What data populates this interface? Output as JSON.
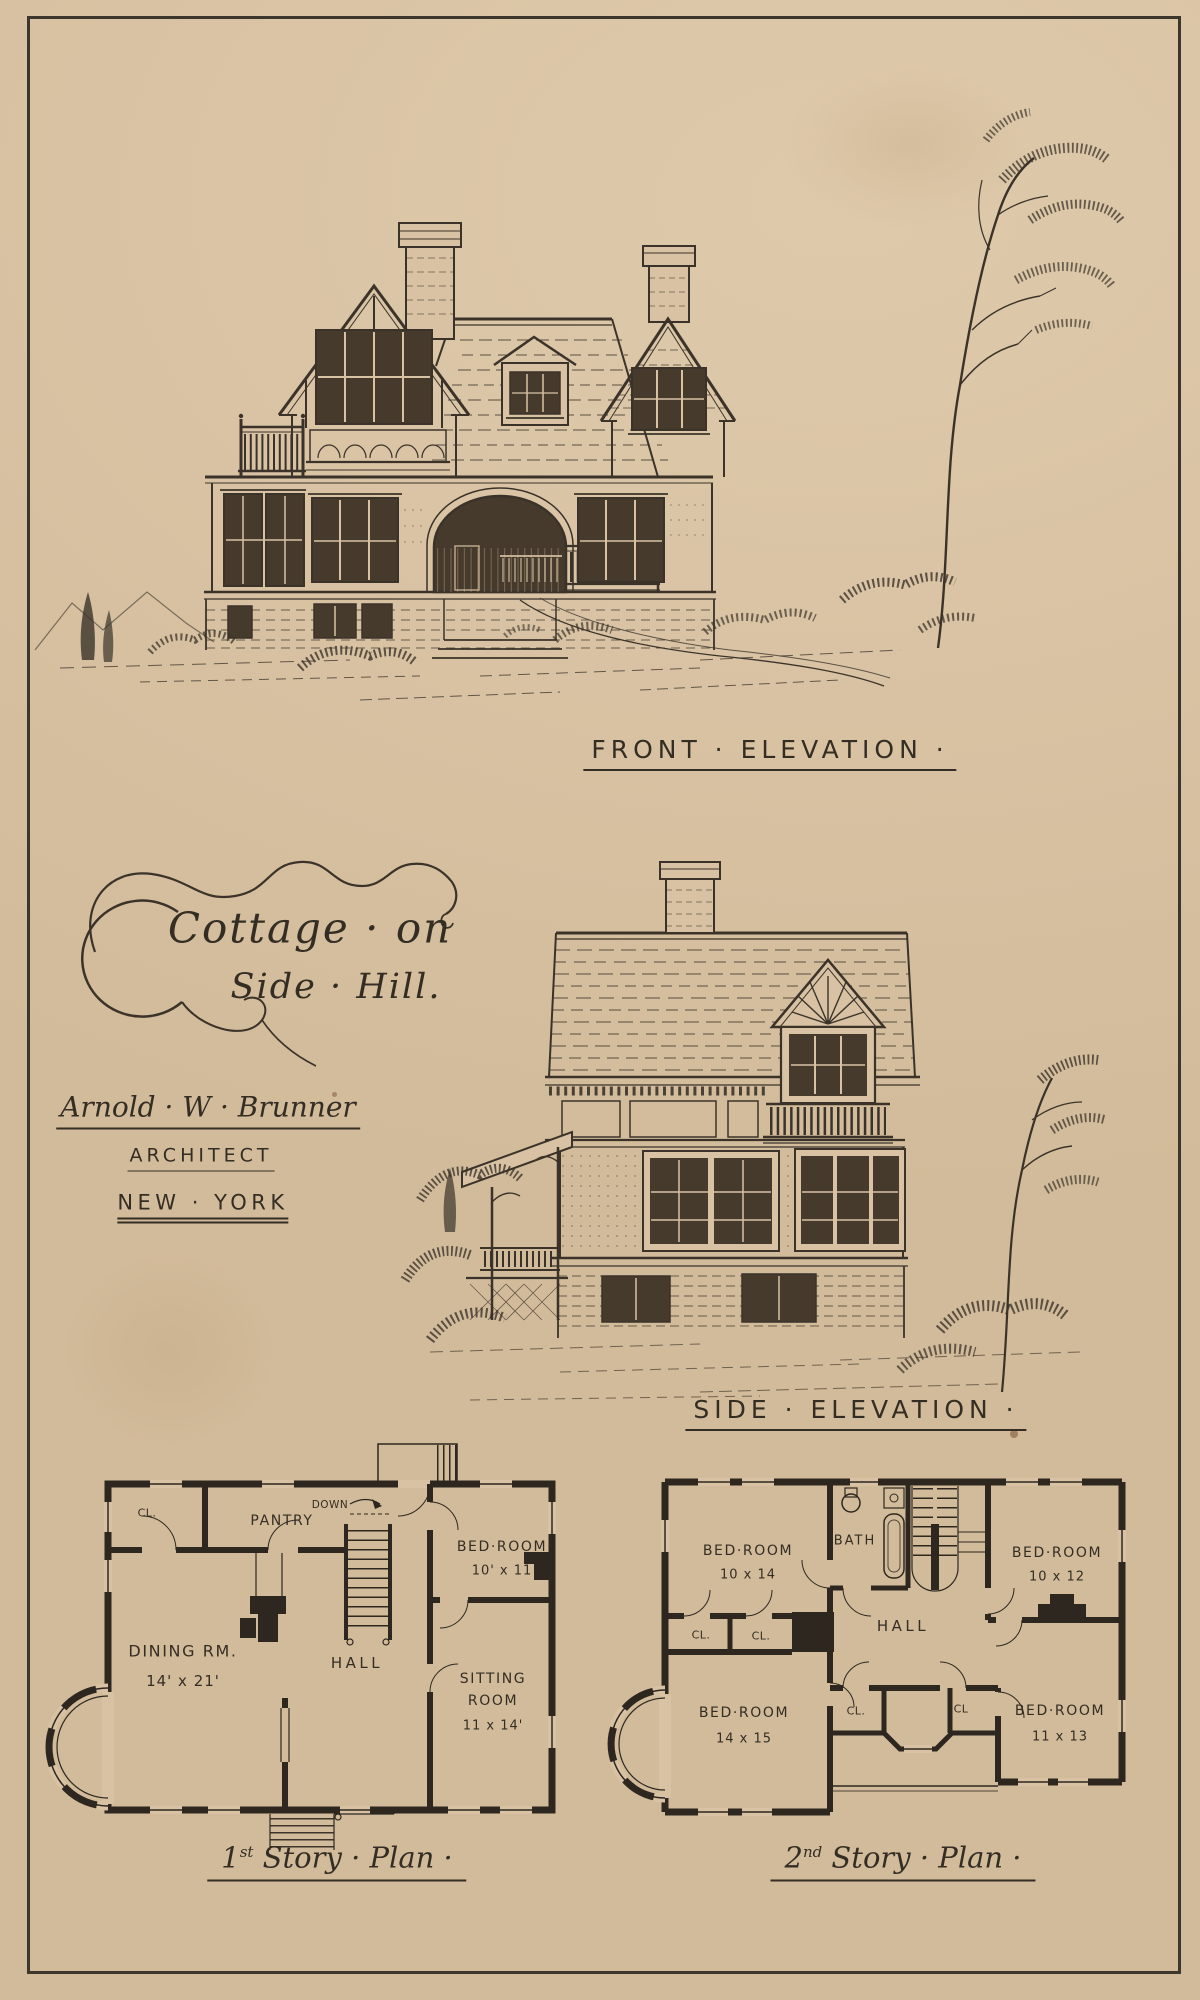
{
  "colors": {
    "paper": "#d8c2a3",
    "ink": "#3b332a"
  },
  "plate": {
    "title_line1": "Cottage · on",
    "title_line2": "Side · Hill.",
    "architect": {
      "name": "Arnold · W · Brunner",
      "title": "ARCHITECT",
      "city": "NEW · YORK"
    },
    "front_elevation_caption": "FRONT · ELEVATION ·",
    "side_elevation_caption": "SIDE · ELEVATION ·"
  },
  "first_story_plan": {
    "caption": {
      "number": "1",
      "ordinal": "st",
      "rest": " Story · Plan ·"
    },
    "labels": {
      "closet": "CL.",
      "pantry": "PANTRY",
      "stairs_direction": "DOWN",
      "bedroom_name": "BED·ROOM",
      "bedroom_size": "10' x 11",
      "dining_name": "DINING RM.",
      "dining_size": "14' x 21'",
      "hall": "HALL",
      "sitting_line1": "SITTING",
      "sitting_line2": "ROOM",
      "sitting_size": "11 x 14'"
    }
  },
  "second_story_plan": {
    "caption": {
      "number": "2",
      "ordinal": "nd",
      "rest": " Story · Plan ·"
    },
    "labels": {
      "bedroom_nw_name": "BED·ROOM",
      "bedroom_nw_size": "10 x 14",
      "bath": "BATH",
      "bedroom_ne_name": "BED·ROOM",
      "bedroom_ne_size": "10 x 12",
      "closet_mid_1": "CL.",
      "closet_mid_2": "CL.",
      "hall": "HALL",
      "bedroom_sw_name": "BED·ROOM",
      "bedroom_sw_size": "14 x 15",
      "closet_s_1": "CL.",
      "closet_s_2": "CL",
      "bedroom_se_name": "BED·ROOM",
      "bedroom_se_size": "11 x 13"
    }
  }
}
